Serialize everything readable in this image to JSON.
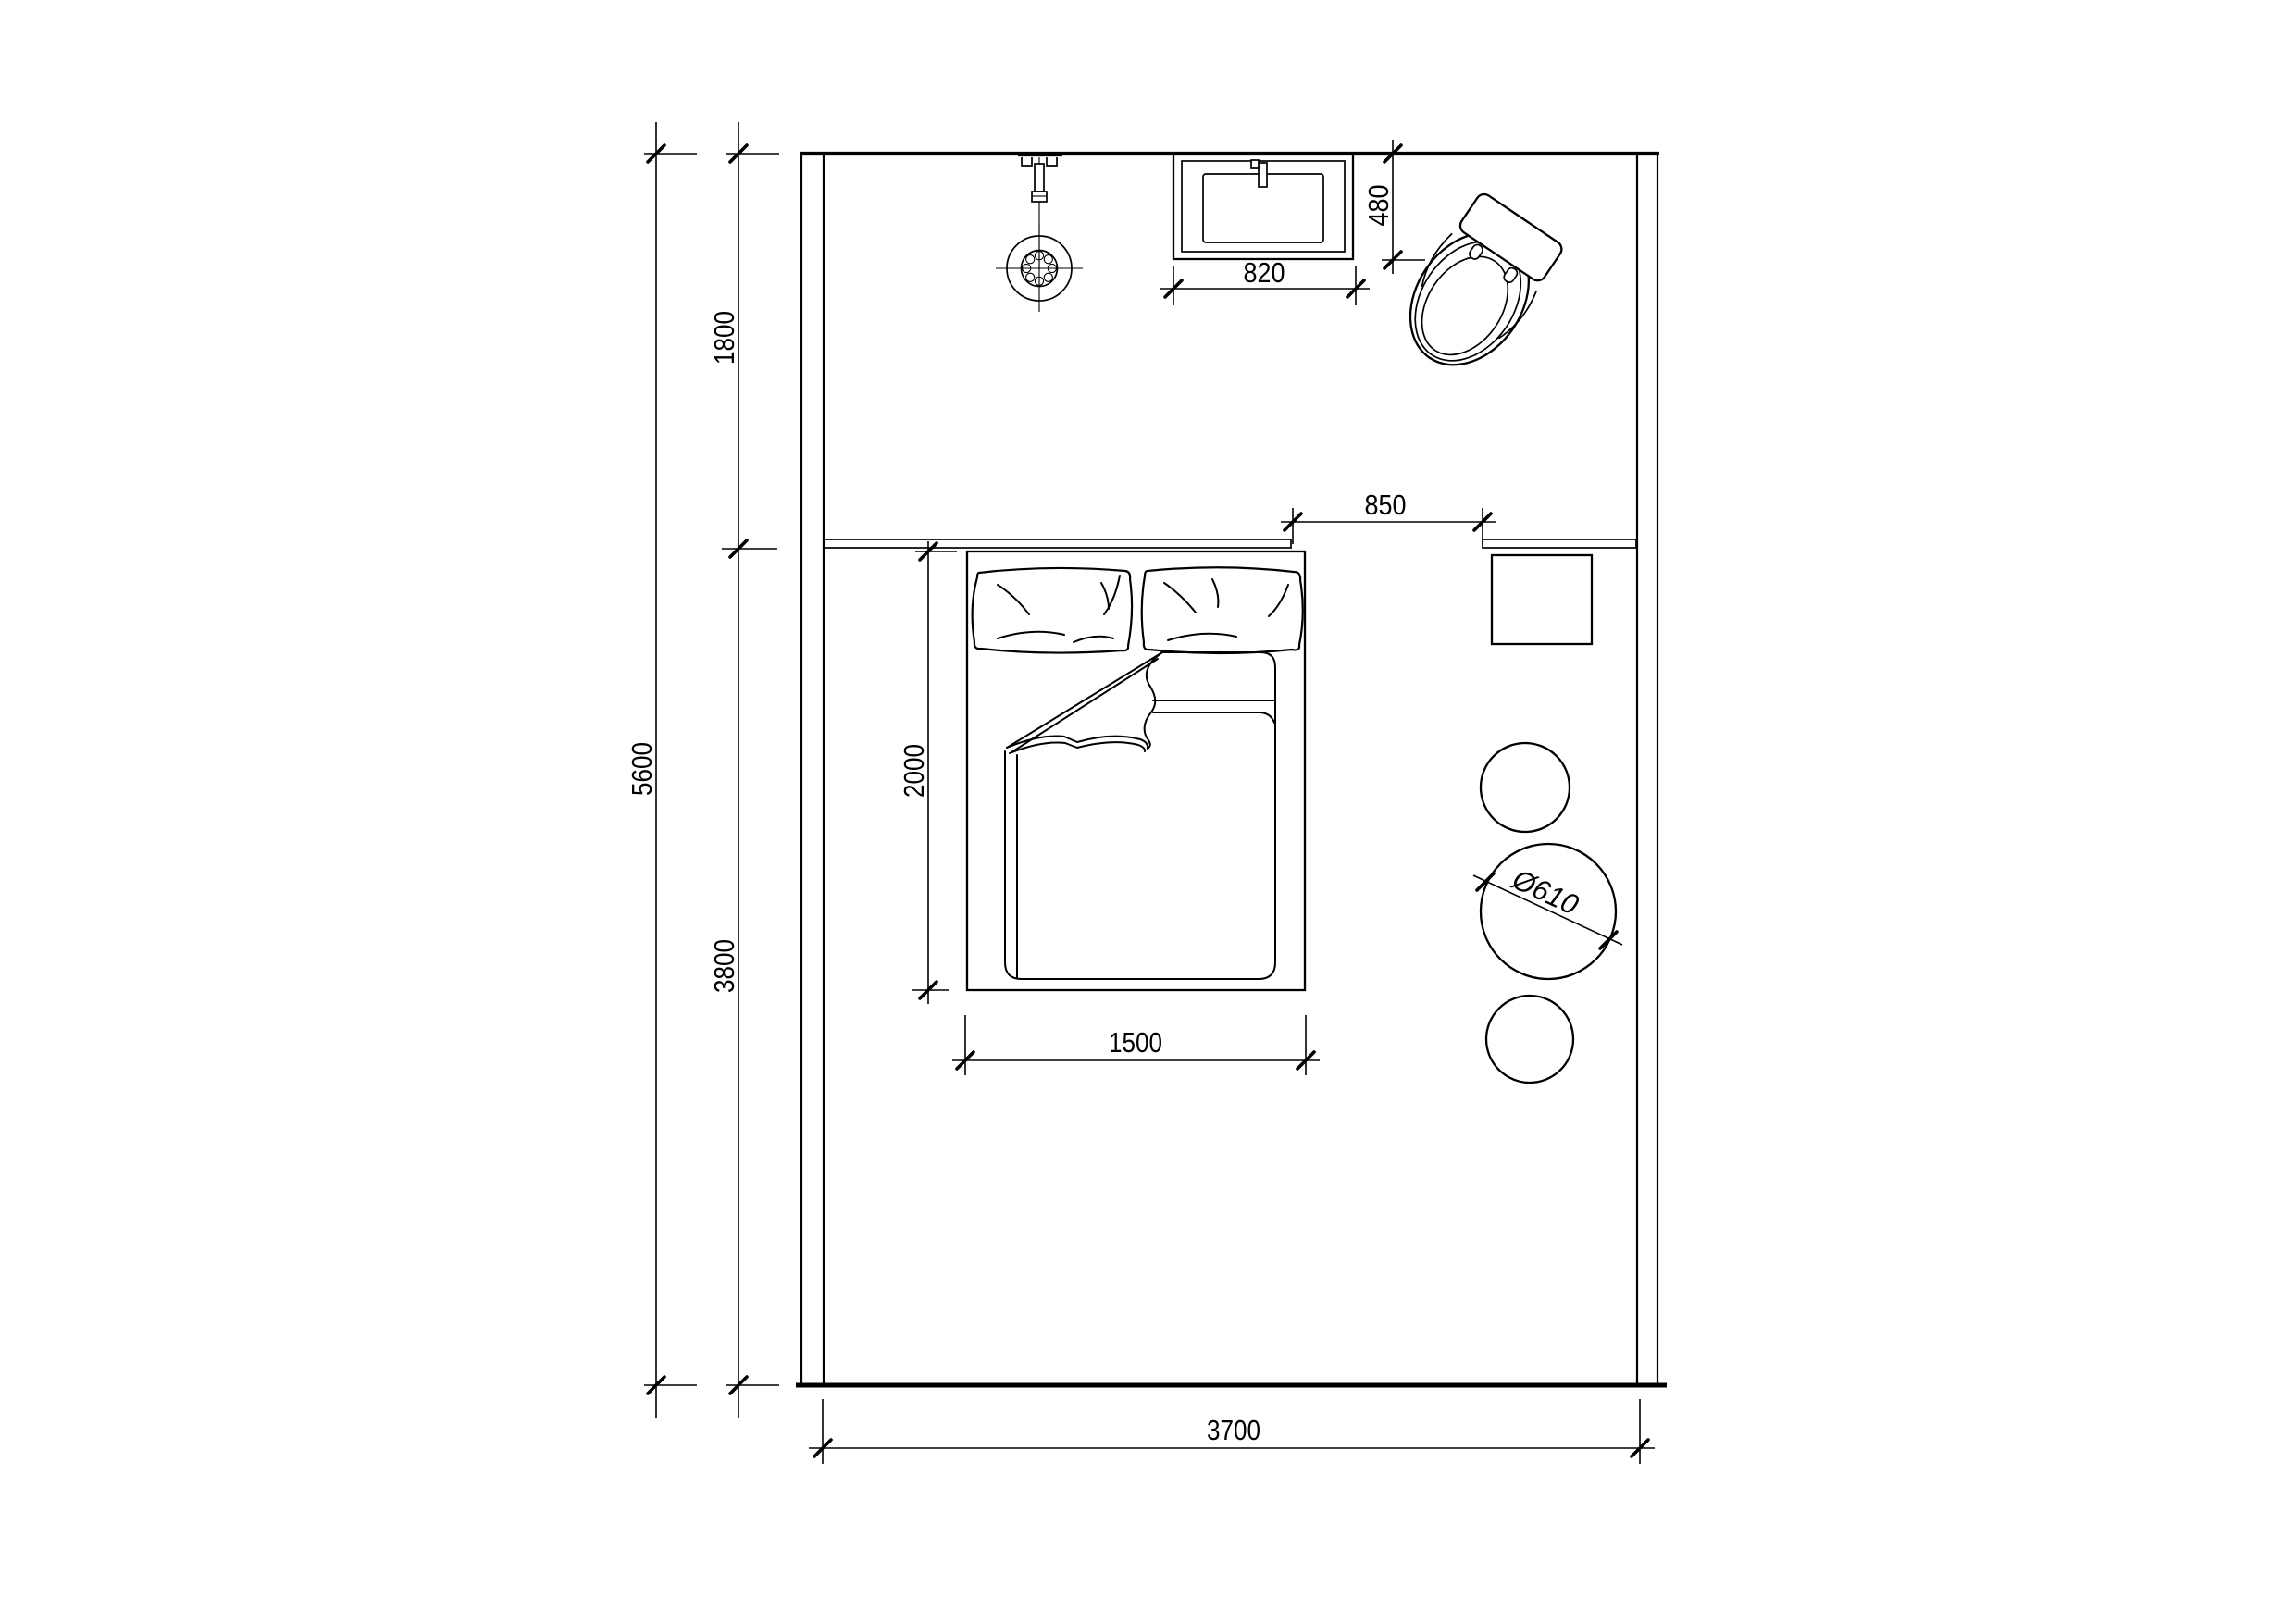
{
  "dimensions": {
    "room_interior_height": "5600",
    "upper_zone_depth": "1800",
    "lower_zone_depth": "3800",
    "room_interior_width": "3700",
    "washbasin_width": "820",
    "washbasin_depth": "480",
    "counter_opening": "850",
    "bed_length": "2000",
    "bed_width": "1500",
    "round_table_diameter": "Ø610"
  }
}
